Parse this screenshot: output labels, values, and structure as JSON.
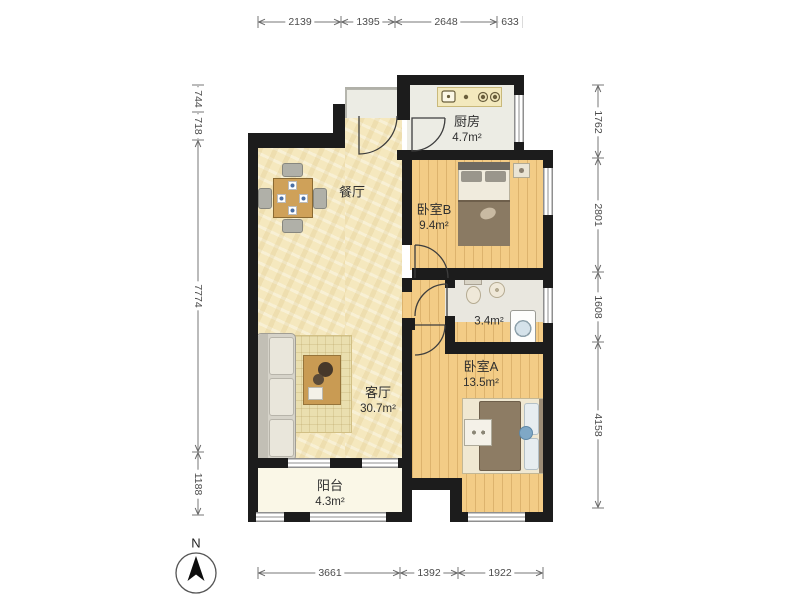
{
  "plan": {
    "title": "apartment-floor-plan",
    "compass": {
      "label": "N"
    },
    "rooms": {
      "dining": {
        "name": "餐厅",
        "area": ""
      },
      "kitchen": {
        "name": "厨房",
        "area": "4.7m²"
      },
      "bedroomB": {
        "name": "卧室B",
        "area": "9.4m²"
      },
      "bathroom": {
        "name": "",
        "area": "3.4m²"
      },
      "living": {
        "name": "客厅",
        "area": "30.7m²"
      },
      "bedroomA": {
        "name": "卧室A",
        "area": "13.5m²"
      },
      "balcony": {
        "name": "阳台",
        "area": "4.3m²"
      }
    },
    "dimensions": {
      "top": [
        "2139",
        "1395",
        "2648",
        "633"
      ],
      "bottom": [
        "3661",
        "1392",
        "1922"
      ],
      "left": [
        "744",
        "718",
        "7774",
        "1188"
      ],
      "right": [
        "1762",
        "2801",
        "1608",
        "4158"
      ]
    },
    "colors": {
      "wall": "#1c1c1c",
      "tile_floor": "#f5e8be",
      "wood_floor": "#f3cc86",
      "kitchen_floor": "#ecece4",
      "balcony_floor": "#faf7e7",
      "dimension_text": "#4c4c4c"
    }
  }
}
